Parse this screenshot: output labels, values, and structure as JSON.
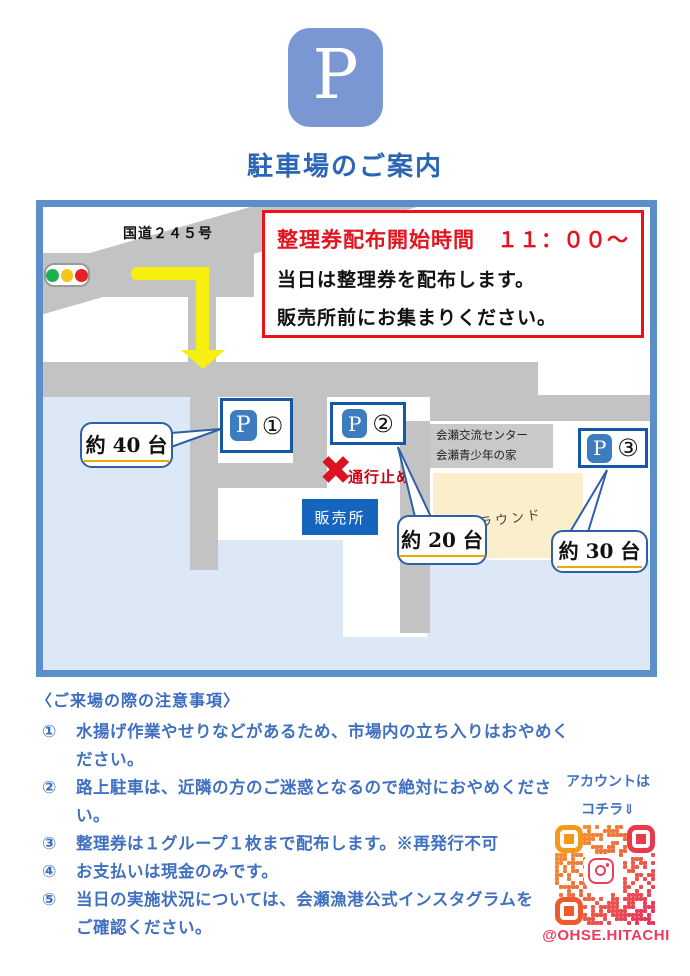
{
  "page": {
    "logo_letter": "P",
    "title": "駐車場のご案内"
  },
  "map": {
    "route_label": "国道２４５号",
    "notice": {
      "line1": "整理券配布開始時間　１１：００～",
      "line2": "当日は整理券を配布します。",
      "line3": "販売所前にお集まりください。"
    },
    "closed_x": "✖",
    "closed_label": "通行止め",
    "sales_office": "販売所",
    "building": {
      "line1": "会瀬交流センター",
      "line2": "会瀬青少年の家"
    },
    "ground": "グラウンド",
    "parkings": [
      {
        "p": "P",
        "num": "①",
        "capacity": "約 40 台"
      },
      {
        "p": "P",
        "num": "②",
        "capacity": "約 20 台"
      },
      {
        "p": "P",
        "num": "③",
        "capacity": "約 30 台"
      }
    ]
  },
  "notes": {
    "header": "〈ご来場の際の注意事項〉",
    "items": [
      {
        "num": "①",
        "text": "水揚げ作業やせりなどがあるため、市場内の立ち入りはおやめください。"
      },
      {
        "num": "②",
        "text": "路上駐車は、近隣の方のご迷惑となるので絶対におやめください。"
      },
      {
        "num": "③",
        "text": "整理券は１グループ１枚まで配布します。※再発行不可"
      },
      {
        "num": "④",
        "text": "お支払いは現金のみです。"
      },
      {
        "num": "⑤",
        "text": "当日の実施状況については、会瀬漁港公式インスタグラムを",
        "text2": "ご確認ください。"
      }
    ]
  },
  "instagram": {
    "caption_line1": "アカウントは",
    "caption_line2": "コチラ⇓",
    "handle": "@OHSE.HITACHI"
  },
  "colors": {
    "logo_blue": "#7b97d3",
    "title_blue": "#2a66b5",
    "map_border": "#5a8fc9",
    "water": "#dce8f5",
    "road": "#c3c3c3",
    "building_gray": "#c9c9c9",
    "ground_beige": "#fbeecb",
    "sales_box_blue": "#1565be",
    "marker_border_blue": "#1558a8",
    "p_chip_blue": "#3e7cc0",
    "notice_border_red": "#ee1218",
    "notice_text_red": "#e11420",
    "closed_red": "#dd1122",
    "bubble_border_blue": "#2e5fa8",
    "capacity_underline": "#f0a800",
    "arrow_yellow": "#f6ef10",
    "notes_blue": "#4070c0",
    "handle_pink": "#ee3a5f",
    "qr_orange": "#f49e29",
    "qr_pink": "#e82f5e",
    "traffic_green": "#1faf4f",
    "traffic_yellow": "#f5c518",
    "traffic_red": "#e82020"
  }
}
